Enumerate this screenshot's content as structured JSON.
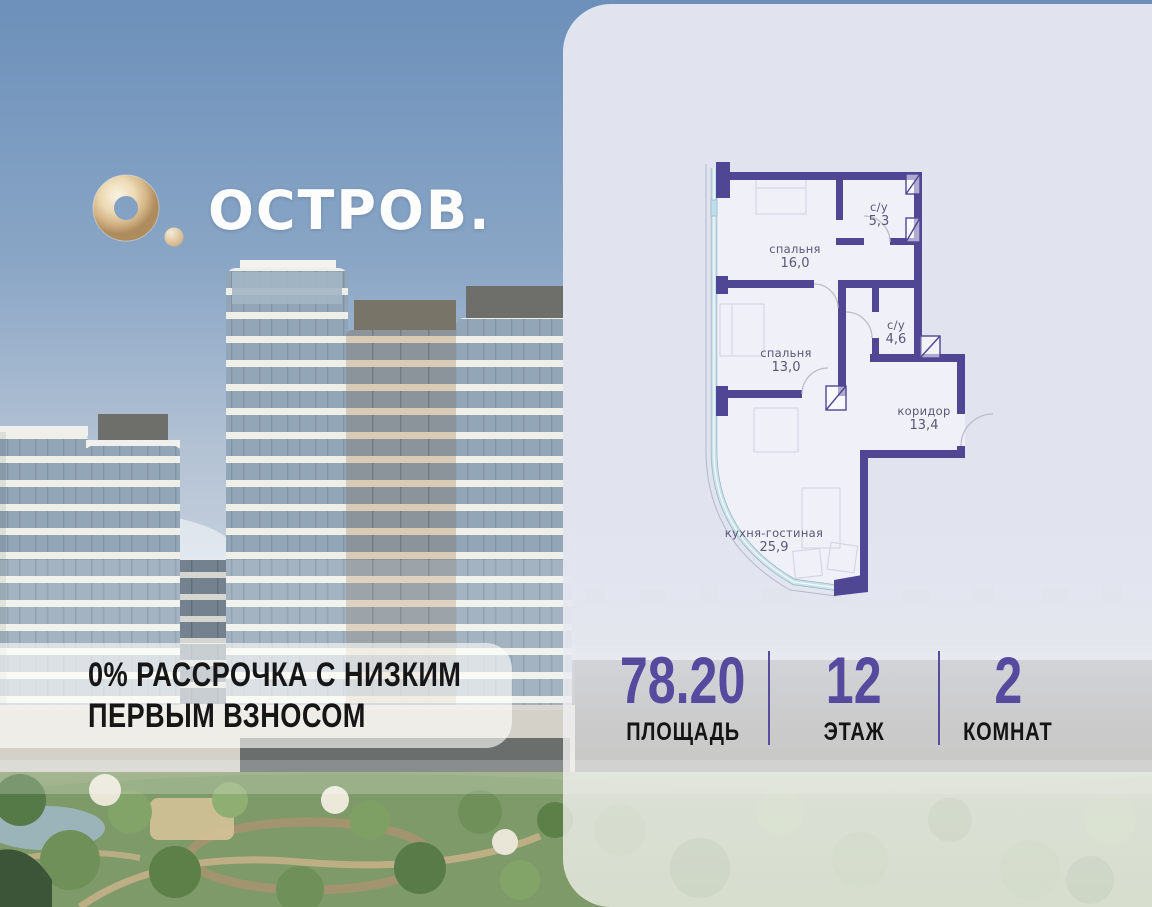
{
  "brand": {
    "logo_text": "ОСТРОВ.",
    "logo_icon": "torus-logo",
    "logo_gold": "#dcc49d"
  },
  "promo_banner": {
    "line1": "0% РАССРОЧКА С НИЗКИМ",
    "line2": "ПЕРВЫМ ВЗНОСОМ"
  },
  "floorplan": {
    "rooms": [
      {
        "name": "спальня",
        "area": "16,0"
      },
      {
        "name": "с/у",
        "area": "5,3"
      },
      {
        "name": "спальня",
        "area": "13,0"
      },
      {
        "name": "с/у",
        "area": "4,6"
      },
      {
        "name": "коридор",
        "area": "13,4"
      },
      {
        "name": "кухня-гостиная",
        "area": "25,9"
      }
    ]
  },
  "stats": {
    "area": {
      "value": "78.20",
      "label": "ПЛОЩАДЬ"
    },
    "floor": {
      "value": "12",
      "label": "ЭТАЖ"
    },
    "rooms": {
      "value": "2",
      "label": "КОМНАТ"
    }
  },
  "colors": {
    "wall": "#4f4694",
    "accent": "#554a9e",
    "panel": "#e1e4ef",
    "glazing": "#c7e2e8"
  }
}
